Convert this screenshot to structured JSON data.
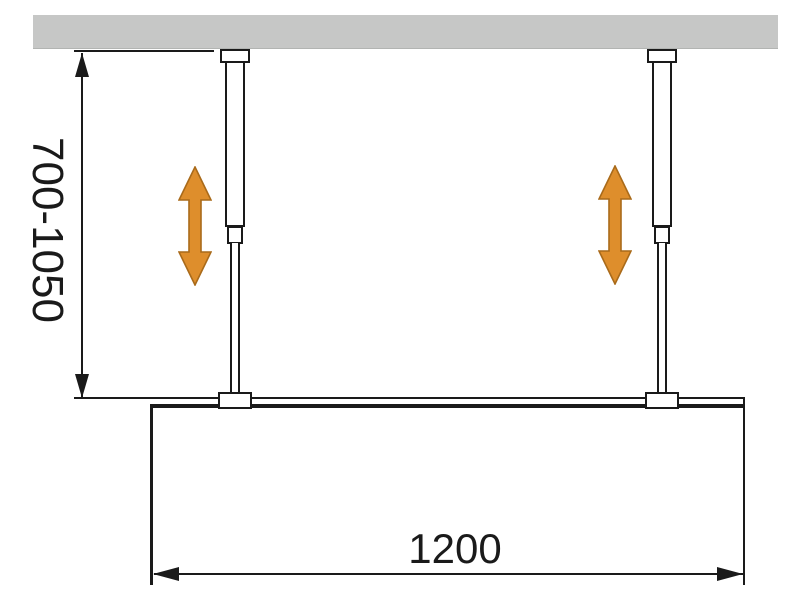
{
  "diagram": {
    "labels": {
      "height_range": "700-1050",
      "width": "1200"
    },
    "colors": {
      "background": "#ffffff",
      "ceiling_fill": "#c6c7c6",
      "line": "#1a1a1a",
      "adjust_arrow_fill": "#de8e2c",
      "adjust_arrow_stroke": "#a96a1a"
    },
    "icons": {
      "left_adjust": "vertical-double-arrow-icon",
      "right_adjust": "vertical-double-arrow-icon"
    }
  }
}
